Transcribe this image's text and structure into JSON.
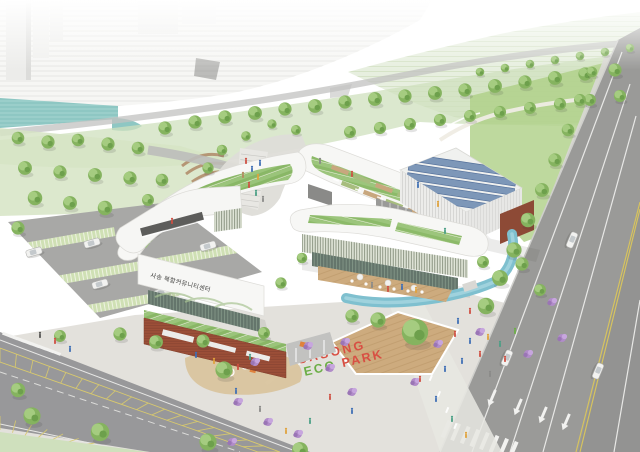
{
  "scene": {
    "type": "architectural aerial rendering of a community center complex",
    "building_sign": "사송 복합커뮤니티센터",
    "eco_park_sign": {
      "word1": "SASONG",
      "word2": "ECO",
      "word3": "PARK"
    },
    "palette": {
      "sign_red": "#d84f43",
      "sign_green": "#6cae46",
      "tree_green": "#85b35f",
      "roof_green": "#89b766",
      "water_teal": "#8ec7c3",
      "pond_blue": "#7fc0cf",
      "road_grey": "#9a9a98",
      "brick_red": "#9c4f38",
      "solar_blue": "#7d97b8",
      "shrub_purple": "#b18cc9",
      "deck_tan": "#cdab7e"
    }
  }
}
